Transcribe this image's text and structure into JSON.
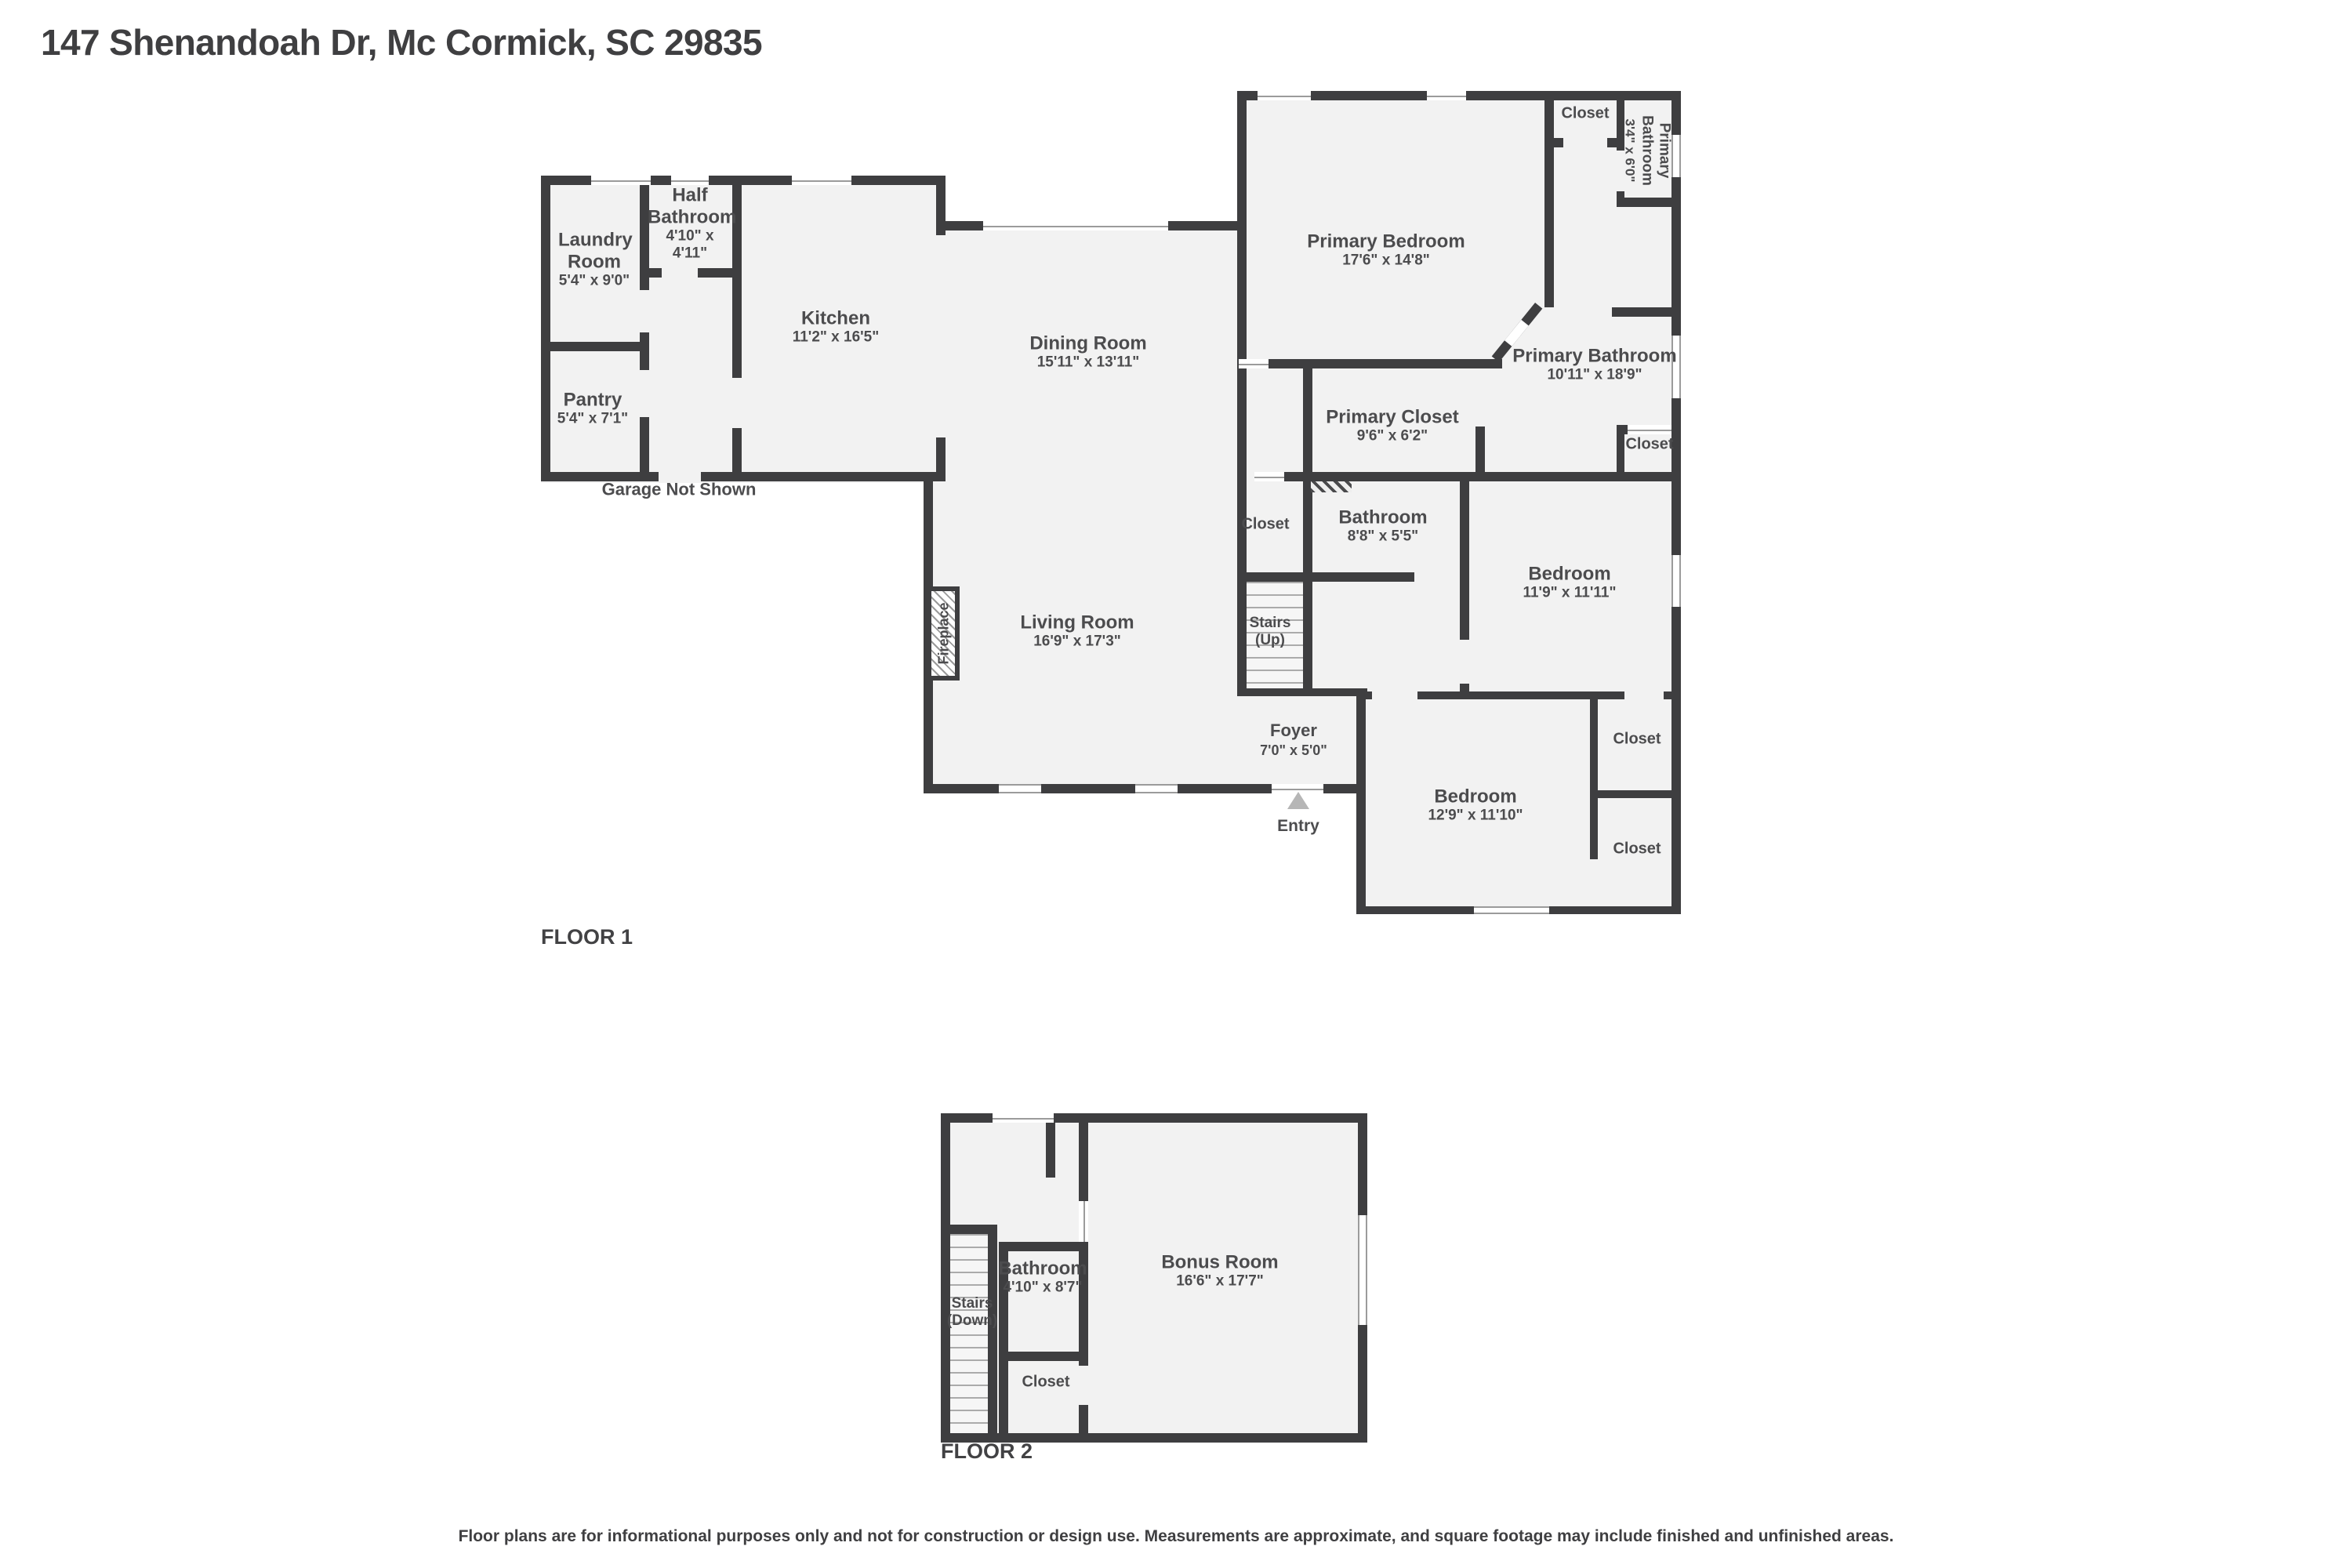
{
  "page": {
    "title": "147 Shenandoah Dr, Mc Cormick, SC 29835",
    "disclaimer": "Floor plans are for informational purposes only and not for construction or design use. Measurements are approximate, and square footage may include finished and unfinished areas."
  },
  "floor1": {
    "label": "FLOOR 1",
    "garage_note": "Garage Not Shown",
    "entry_label": "Entry",
    "fireplace_label": "Fireplace",
    "stairs": {
      "name": "Stairs (Up)"
    },
    "rooms": {
      "laundry": {
        "name": "Laundry Room",
        "dims": "5'4\" x 9'0\""
      },
      "half_bathroom": {
        "name": "Half Bathroom",
        "dims": "4'10\" x 4'11\""
      },
      "pantry": {
        "name": "Pantry",
        "dims": "5'4\" x 7'1\""
      },
      "kitchen": {
        "name": "Kitchen",
        "dims": "11'2\" x 16'5\""
      },
      "dining": {
        "name": "Dining Room",
        "dims": "15'11\" x 13'11\""
      },
      "living": {
        "name": "Living Room",
        "dims": "16'9\" x 17'3\""
      },
      "primary_bedroom": {
        "name": "Primary Bedroom",
        "dims": "17'6\" x 14'8\""
      },
      "closet_top": {
        "name": "Closet"
      },
      "primary_bathroom_small": {
        "name": "Primary Bathroom",
        "dims": "3'4\" x 6'0\""
      },
      "primary_bathroom": {
        "name": "Primary Bathroom",
        "dims": "10'11\" x 18'9\""
      },
      "primary_closet": {
        "name": "Primary Closet",
        "dims": "9'6\" x 6'2\""
      },
      "closet_mid": {
        "name": "Closet"
      },
      "hall_closet": {
        "name": "Closet"
      },
      "bathroom": {
        "name": "Bathroom",
        "dims": "8'8\" x 5'5\""
      },
      "bedroom_mid": {
        "name": "Bedroom",
        "dims": "11'9\" x 11'11\""
      },
      "foyer": {
        "name": "Foyer",
        "dims": "7'0\" x 5'0\""
      },
      "bedroom_bottom": {
        "name": "Bedroom",
        "dims": "12'9\" x 11'10\""
      },
      "closet_b1": {
        "name": "Closet"
      },
      "closet_b2": {
        "name": "Closet"
      }
    }
  },
  "floor2": {
    "label": "FLOOR 2",
    "stairs": {
      "name": "Stairs (Down)"
    },
    "rooms": {
      "bathroom": {
        "name": "Bathroom",
        "dims": "4'10\" x 8'7\""
      },
      "closet": {
        "name": "Closet"
      },
      "bonus": {
        "name": "Bonus Room",
        "dims": "16'6\" x 17'7\""
      }
    }
  },
  "colors": {
    "wall": "#3e3e40",
    "room_fill": "#f2f2f2",
    "text": "#4c4c4e",
    "entry_marker": "#b6b6b6"
  }
}
